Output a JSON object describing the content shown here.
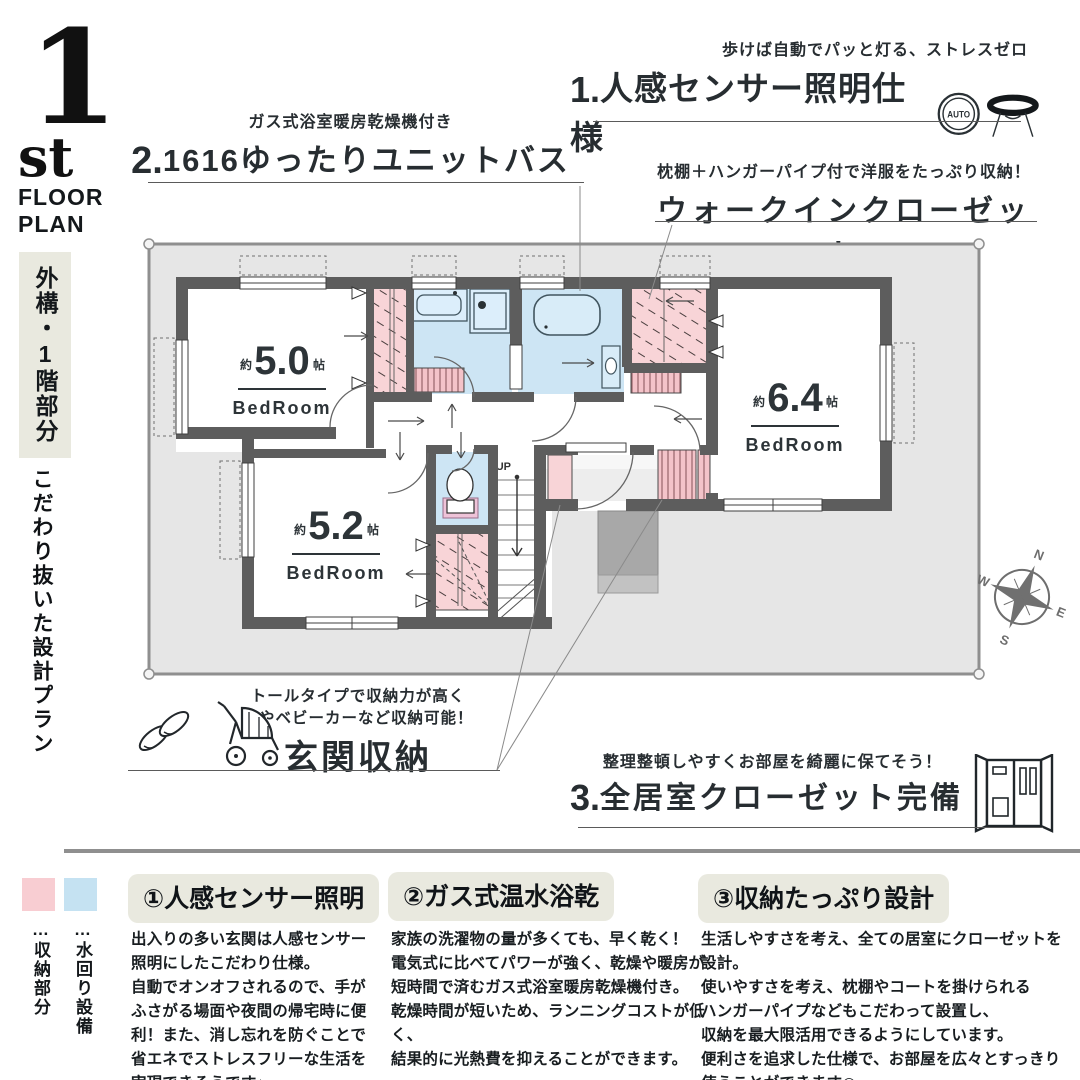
{
  "header": {
    "floor_number": "1",
    "floor_suffix": "st",
    "floor_word1": "FLOOR",
    "floor_word2": "PLAN"
  },
  "sidebar": {
    "tag": "外構・1階部分",
    "catchphrase": "こだわり抜いた設計プラン"
  },
  "callouts": {
    "unit_bath": {
      "note": "ガス式浴室暖房乾燥機付き",
      "number": "2.",
      "title": "1616ゆったりユニットバス"
    },
    "sensor_light": {
      "note": "歩けば自動でパッと灯る、ストレスゼロ",
      "number": "1.",
      "title": "人感センサー照明仕様",
      "auto_label": "AUTO"
    },
    "wic": {
      "note": "枕棚＋ハンガーパイプ付で洋服をたっぷり収納！",
      "title": "ウォークインクローゼット"
    },
    "genkan": {
      "note_line1": "トールタイプで収納力が高く",
      "note_line2": "傘やベビーカーなど収納可能！",
      "title": "玄関収納"
    },
    "all_closets": {
      "note": "整理整頓しやすくお部屋を綺麗に保てそう！",
      "number": "3.",
      "title": "全居室クローゼット完備"
    }
  },
  "floor_plan": {
    "rooms": [
      {
        "size_prefix": "約",
        "size": "5.0",
        "size_unit": "帖",
        "name": "BedRoom"
      },
      {
        "size_prefix": "約",
        "size": "5.2",
        "size_unit": "帖",
        "name": "BedRoom"
      },
      {
        "size_prefix": "約",
        "size": "6.4",
        "size_unit": "帖",
        "name": "BedRoom"
      }
    ],
    "stairs_label": "UP",
    "compass": {
      "n": "N",
      "e": "E",
      "s": "S",
      "w": "W"
    },
    "colors": {
      "storage_pink": "#f8d4d7",
      "water_blue": "#cde5f4",
      "wall_gray": "#5d5d5d",
      "site_gray": "#e6e6e6",
      "porch_gray": "#a8a8a8"
    }
  },
  "legend": {
    "storage": {
      "swatch_color": "#f8cdd2",
      "label": "…収納部分"
    },
    "water": {
      "swatch_color": "#c5e2f2",
      "label": "…水回り設備"
    }
  },
  "features": [
    {
      "heading": "①人感センサー照明",
      "body": "出入りの多い玄関は人感センサー\n照明にしたこだわり仕様。\n自動でオンオフされるので、手が\nふさがる場面や夜間の帰宅時に便\n利！また、消し忘れを防ぐことで\n省エネでストレスフリーな生活を\n実現できそうです♪"
    },
    {
      "heading": "②ガス式温水浴乾",
      "body": "家族の洗濯物の量が多くても、早く乾く！\n電気式に比べてパワーが強く、乾燥や暖房が\n短時間で済むガス式浴室暖房乾燥機付き。\n乾燥時間が短いため、ランニングコストが低く、\n結果的に光熱費を抑えることができます。"
    },
    {
      "heading": "③収納たっぷり設計",
      "body": "生活しやすさを考え、全ての居室にクローゼットを設計。\n使いやすさを考え、枕棚やコートを掛けられる\nハンガーパイプなどもこだわって設置し、\n収納を最大限活用できるようにしています。\n便利さを追求した仕様で、お部屋を広々とすっきり\n使うことができます◎"
    }
  ]
}
